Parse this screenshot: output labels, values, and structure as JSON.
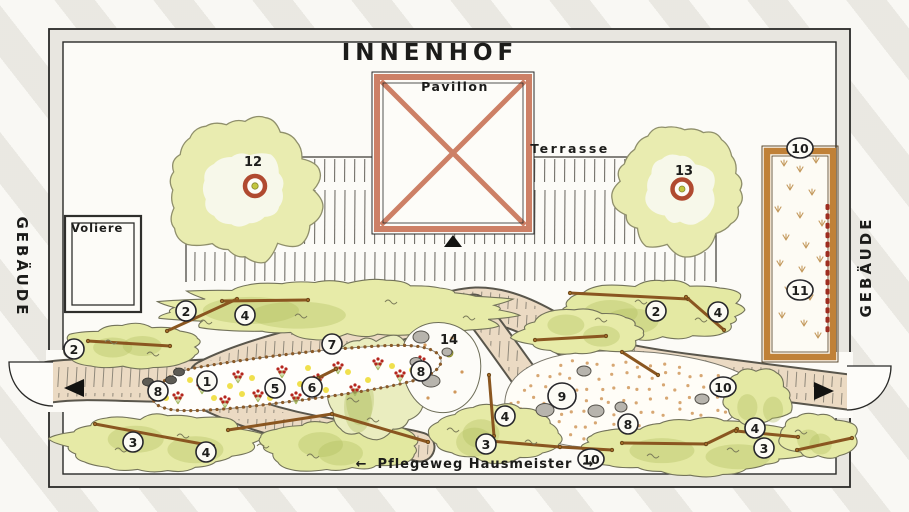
{
  "title": "INNENHOF",
  "labels": {
    "pavilion": "Pavillon",
    "terrace": "Terrasse",
    "aviary": "Voliere",
    "building_left": "GEBÄUDE",
    "building_right": "GEBÄUDE",
    "maintenance_path": "Pflegeweg Hausmeister",
    "arrow_left": "←",
    "arrow_right": "→"
  },
  "colors": {
    "pavilion_accent": "#cd8066",
    "tree_foliage": "#e9ecb0",
    "hedge_green": "#e6eaa6",
    "path_tan": "#ebdac3",
    "flower_red": "#b5251d",
    "flower_yellow": "#eedd3a",
    "wood_frame": "#c08138",
    "stone_gray": "#b7b4ad",
    "ink": "#2a2a28"
  },
  "markers": [
    {
      "label": "1",
      "x": 207,
      "y": 381,
      "circled": true
    },
    {
      "label": "2",
      "x": 74,
      "y": 349,
      "circled": true
    },
    {
      "label": "2",
      "x": 186,
      "y": 311,
      "circled": true
    },
    {
      "label": "2",
      "x": 656,
      "y": 311,
      "circled": true
    },
    {
      "label": "3",
      "x": 133,
      "y": 442,
      "circled": true
    },
    {
      "label": "3",
      "x": 486,
      "y": 444,
      "circled": true
    },
    {
      "label": "3",
      "x": 764,
      "y": 448,
      "circled": true
    },
    {
      "label": "4",
      "x": 245,
      "y": 315,
      "circled": true
    },
    {
      "label": "4",
      "x": 718,
      "y": 312,
      "circled": true
    },
    {
      "label": "4",
      "x": 206,
      "y": 452,
      "circled": true
    },
    {
      "label": "4",
      "x": 505,
      "y": 416,
      "circled": true
    },
    {
      "label": "4",
      "x": 755,
      "y": 428,
      "circled": true
    },
    {
      "label": "5",
      "x": 275,
      "y": 388,
      "circled": true
    },
    {
      "label": "6",
      "x": 312,
      "y": 387,
      "circled": true
    },
    {
      "label": "7",
      "x": 332,
      "y": 344,
      "circled": true
    },
    {
      "label": "8",
      "x": 158,
      "y": 391,
      "circled": true
    },
    {
      "label": "8",
      "x": 421,
      "y": 371,
      "circled": true
    },
    {
      "label": "8",
      "x": 628,
      "y": 424,
      "circled": true
    },
    {
      "label": "9",
      "x": 562,
      "y": 396,
      "circled": true,
      "r": 14
    },
    {
      "label": "10",
      "x": 800,
      "y": 148,
      "circled": true
    },
    {
      "label": "10",
      "x": 723,
      "y": 387,
      "circled": true
    },
    {
      "label": "10",
      "x": 591,
      "y": 459,
      "circled": true
    },
    {
      "label": "11",
      "x": 800,
      "y": 290,
      "circled": true
    },
    {
      "label": "12",
      "x": 253,
      "y": 162,
      "circled": false
    },
    {
      "label": "13",
      "x": 684,
      "y": 171,
      "circled": false
    },
    {
      "label": "14",
      "x": 449,
      "y": 340,
      "circled": false
    }
  ]
}
